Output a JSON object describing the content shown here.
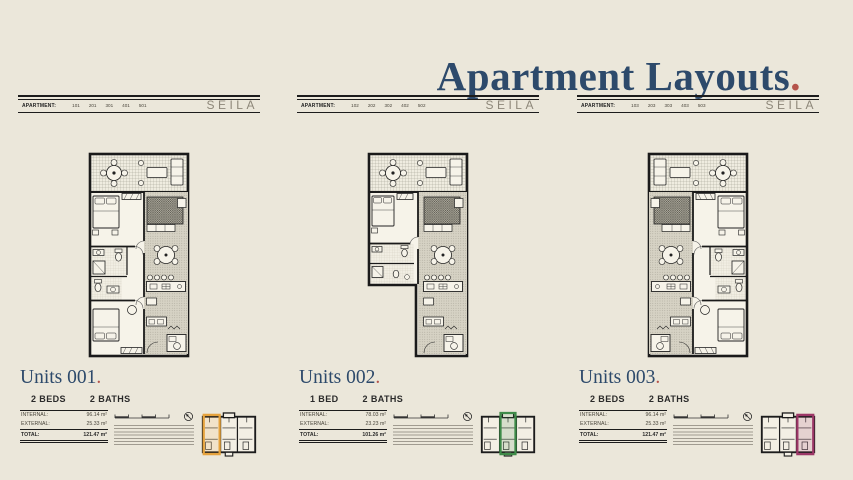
{
  "page": {
    "title": "Apartment Layouts",
    "period": ".",
    "background": "#ebe7da",
    "title_color": "#2d4a6b",
    "accent_red": "#b5544b"
  },
  "brand": "SEILA",
  "labels": {
    "apartment": "APARTMENT:",
    "internal": "INTERNAL:",
    "external": "EXTERNAL:",
    "total": "TOTAL:"
  },
  "units": [
    {
      "number": "001",
      "title": "Units 001",
      "beds": "2 BEDS",
      "baths": "2 BATHS",
      "apartments": [
        "101",
        "201",
        "301",
        "401",
        "501"
      ],
      "areas": {
        "internal": "96.14 m²",
        "external": "25.33 m²",
        "total": "121.47 m²"
      },
      "highlight": "#e6a33d"
    },
    {
      "number": "002",
      "title": "Units 002",
      "beds": "1 BED",
      "baths": "2 BATHS",
      "apartments": [
        "102",
        "202",
        "302",
        "402",
        "502"
      ],
      "areas": {
        "internal": "78.03 m²",
        "external": "23.23 m²",
        "total": "101.26 m²"
      },
      "highlight": "#3e8b48"
    },
    {
      "number": "003",
      "title": "Units 003",
      "beds": "2 BEDS",
      "baths": "2 BATHS",
      "apartments": [
        "103",
        "203",
        "303",
        "403",
        "503"
      ],
      "areas": {
        "internal": "96.14 m²",
        "external": "25.33 m²",
        "total": "121.47 m²"
      },
      "highlight": "#9d3767"
    }
  ]
}
